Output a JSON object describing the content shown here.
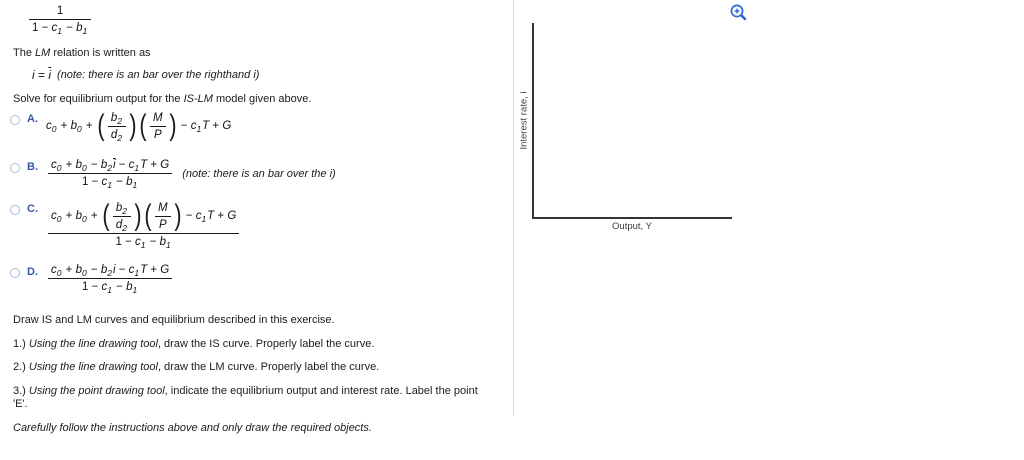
{
  "colors": {
    "option_letter_blue": "#3a57a8",
    "radio_border": "#a6bcdc",
    "zoom_icon_blue": "#2b6bd8",
    "axis_color": "#333333",
    "divider_color": "#d8d8d8"
  },
  "intro": {
    "top_fraction": [
      {
        "frac": {
          "num": [
            {
              "o": "1"
            }
          ],
          "den": [
            {
              "o": "1 − "
            },
            {
              "v": "c",
              "s": "1"
            },
            {
              "o": " − "
            },
            {
              "v": "b",
              "s": "1"
            }
          ]
        }
      }
    ],
    "lm_relation_text": [
      {
        "t": "The "
      },
      {
        "i": "LM"
      },
      {
        "t": " relation is written as"
      }
    ],
    "i_equation": [
      {
        "v": "i"
      },
      {
        "o": " = "
      },
      {
        "vbar": "i"
      }
    ],
    "i_equation_note": [
      {
        "i": "(note: there is an bar over the righthand i)"
      }
    ],
    "solve_prompt": [
      {
        "t": "Solve for equilibrium output for the "
      },
      {
        "i": "IS-LM"
      },
      {
        "t": " model given above."
      }
    ]
  },
  "options": [
    {
      "letter": "A.",
      "formula": [
        {
          "v": "c",
          "s": "0"
        },
        {
          "o": " + "
        },
        {
          "v": "b",
          "s": "0"
        },
        {
          "o": " + "
        },
        {
          "pfrac": {
            "num": [
              {
                "v": "b",
                "s": "2"
              }
            ],
            "den": [
              {
                "v": "d",
                "s": "2"
              }
            ]
          }
        },
        {
          "pfrac": {
            "num": [
              {
                "v": "M"
              }
            ],
            "den": [
              {
                "v": "P"
              }
            ]
          }
        },
        {
          "o": " − "
        },
        {
          "v": "c",
          "s": "1"
        },
        {
          "v": "T"
        },
        {
          "o": " + "
        },
        {
          "v": "G"
        }
      ]
    },
    {
      "letter": "B.",
      "formula": [
        {
          "frac": {
            "num": [
              {
                "v": "c",
                "s": "0"
              },
              {
                "o": " + "
              },
              {
                "v": "b",
                "s": "0"
              },
              {
                "o": " − "
              },
              {
                "v": "b",
                "s": "2"
              },
              {
                "vbar": "i"
              },
              {
                "o": " − "
              },
              {
                "v": "c",
                "s": "1"
              },
              {
                "v": "T"
              },
              {
                "o": " + "
              },
              {
                "v": "G"
              }
            ],
            "den": [
              {
                "o": "1 − "
              },
              {
                "v": "c",
                "s": "1"
              },
              {
                "o": " − "
              },
              {
                "v": "b",
                "s": "1"
              }
            ]
          }
        }
      ],
      "note": [
        {
          "i": "(note: there is an bar over the i)"
        }
      ]
    },
    {
      "letter": "C.",
      "formula": [
        {
          "frac": {
            "num": [
              {
                "v": "c",
                "s": "0"
              },
              {
                "o": " + "
              },
              {
                "v": "b",
                "s": "0"
              },
              {
                "o": " + "
              },
              {
                "pfrac": {
                  "num": [
                    {
                      "v": "b",
                      "s": "2"
                    }
                  ],
                  "den": [
                    {
                      "v": "d",
                      "s": "2"
                    }
                  ]
                }
              },
              {
                "pfrac": {
                  "num": [
                    {
                      "v": "M"
                    }
                  ],
                  "den": [
                    {
                      "v": "P"
                    }
                  ]
                }
              },
              {
                "o": " − "
              },
              {
                "v": "c",
                "s": "1"
              },
              {
                "v": "T"
              },
              {
                "o": " + "
              },
              {
                "v": "G"
              }
            ],
            "den": [
              {
                "o": "1 − "
              },
              {
                "v": "c",
                "s": "1"
              },
              {
                "o": " − "
              },
              {
                "v": "b",
                "s": "1"
              }
            ]
          }
        }
      ]
    },
    {
      "letter": "D.",
      "formula": [
        {
          "frac": {
            "num": [
              {
                "v": "c",
                "s": "0"
              },
              {
                "o": " + "
              },
              {
                "v": "b",
                "s": "0"
              },
              {
                "o": " − "
              },
              {
                "v": "b",
                "s": "2"
              },
              {
                "v": "i"
              },
              {
                "o": " − "
              },
              {
                "v": "c",
                "s": "1"
              },
              {
                "v": "T"
              },
              {
                "o": " + "
              },
              {
                "v": "G"
              }
            ],
            "den": [
              {
                "o": "1 − "
              },
              {
                "v": "c",
                "s": "1"
              },
              {
                "o": " − "
              },
              {
                "v": "b",
                "s": "1"
              }
            ]
          }
        }
      ]
    }
  ],
  "instructions": {
    "heading": "Draw IS and LM curves and equilibrium described in this exercise.",
    "steps": [
      [
        {
          "t": "1.) "
        },
        {
          "i": "Using the line drawing tool"
        },
        {
          "t": ", draw the IS curve. Properly label the curve."
        }
      ],
      [
        {
          "t": "2.) "
        },
        {
          "i": "Using the line drawing tool"
        },
        {
          "t": ", draw the LM curve. Properly label the curve."
        }
      ],
      [
        {
          "t": "3.) "
        },
        {
          "i": "Using the point drawing tool"
        },
        {
          "t": ", indicate the equilibrium output and interest rate. Label the point 'E'."
        }
      ]
    ],
    "footer": [
      {
        "i": "Carefully follow the instructions above and only draw the required objects."
      }
    ]
  },
  "graph": {
    "y_axis_label": "Interest rate, i",
    "x_axis_label": "Output, Y",
    "zoom_icon": "zoom-in-icon"
  }
}
